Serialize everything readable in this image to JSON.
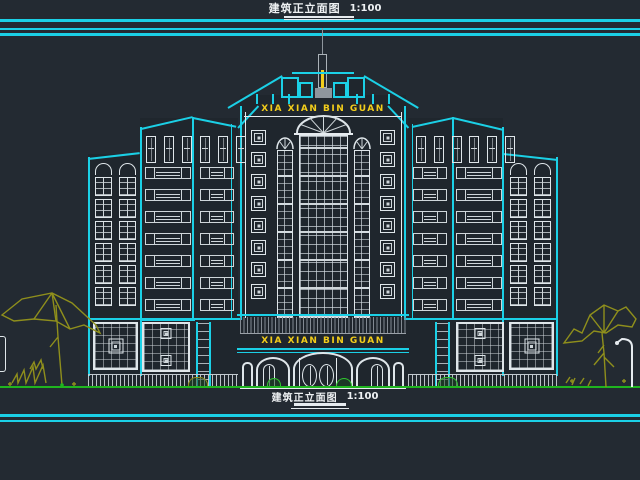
{
  "titles": {
    "top": {
      "label": "建筑正立面图",
      "scale": "1:100"
    },
    "bottom": {
      "label": "建筑正立面图",
      "scale": "1:100"
    }
  },
  "signs": {
    "roof": "XIA XIAN BIN GUAN",
    "entrance": "XIA XIAN BIN GUAN"
  },
  "colors": {
    "background": "#232a32",
    "line_cyan": "#1bd0e6",
    "line_white": "#e6ebef",
    "sign_yellow": "#f2cd1b",
    "tree_olive": "#8f8f1c",
    "ground_green": "#1fb51f",
    "hatch_gray": "#9aa1a8"
  },
  "structure": {
    "tower_medallions": 8,
    "wing_band_rows": 7,
    "wing_top_windows": 3,
    "outer_wing_stack": 6
  }
}
